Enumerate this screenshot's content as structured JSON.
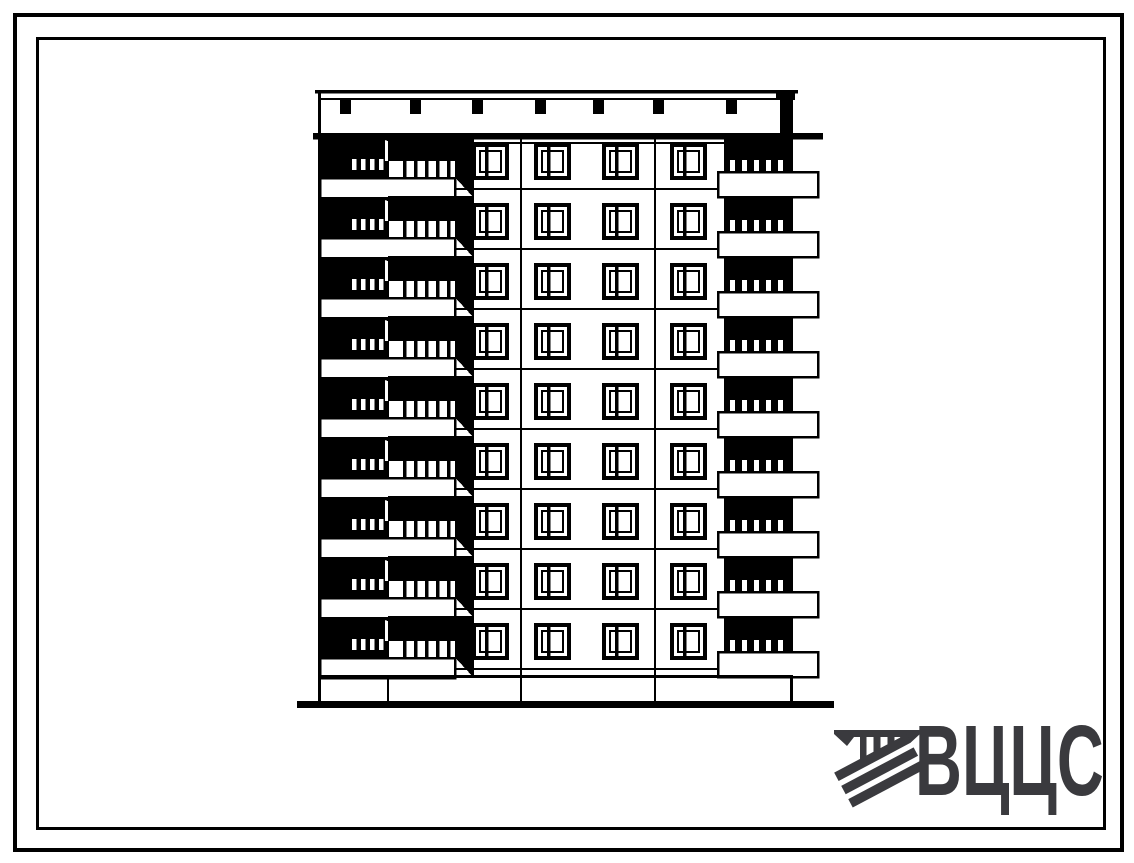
{
  "page": {
    "description": "Scanned black-and-white architectural end-elevation drawing of a nine-storey large-panel apartment building, framed by a double rectangular border, with the organisation logotype in the lower right corner",
    "paper_color": "#ffffff",
    "ink_color": "#000000"
  },
  "drawing": {
    "subject": "nine-storey panel building elevation",
    "floors": 9,
    "windows_per_floor": 4,
    "window_xs": [
      474,
      536,
      604,
      672
    ],
    "parapet_stub_xs": [
      345,
      415,
      477,
      540,
      598,
      658,
      731
    ],
    "left_balcony_ticks": 4,
    "right_balcony_ticks": 5,
    "joint_xs": [
      387,
      520,
      654
    ]
  },
  "logo": {
    "text": "ВЦЦС",
    "color": "#3a3a3e",
    "emblem": "striped-monogram-icon"
  }
}
